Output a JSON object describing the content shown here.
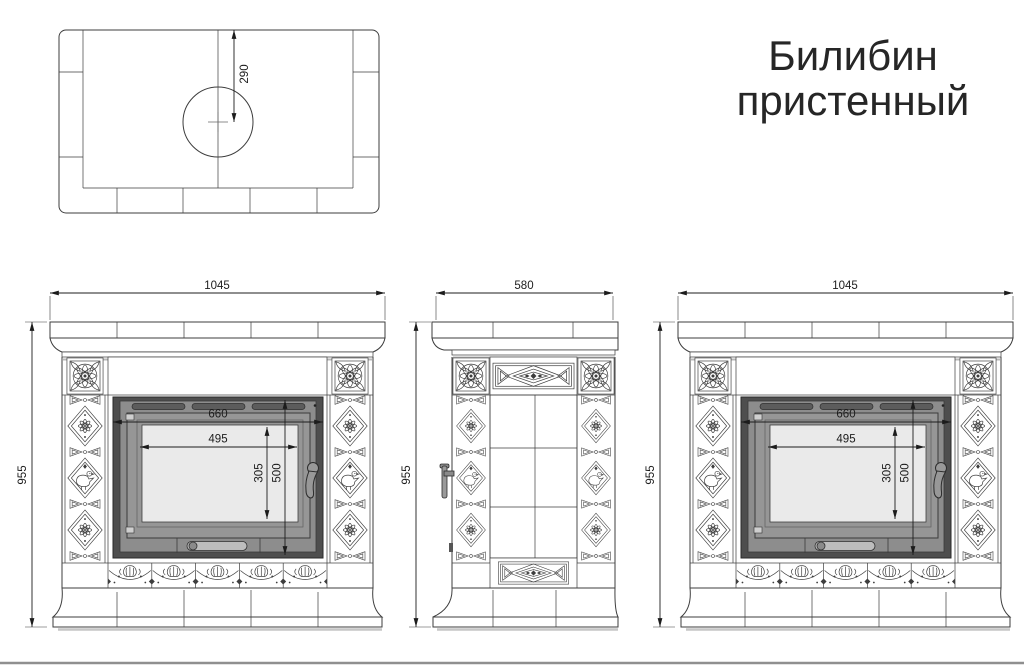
{
  "title": {
    "line1": "Билибин",
    "line2": "пристенный"
  },
  "plan_view": {
    "flue_center_offset": "290"
  },
  "front_view": {
    "width": "1045",
    "height": "955"
  },
  "side_view": {
    "width": "580",
    "height": "955"
  },
  "firebox": {
    "opening_width": "660",
    "glass_width": "495",
    "glass_height": "305",
    "door_height": "500"
  },
  "colors": {
    "line": "#3d3d3d",
    "dimension": "#1c1c1c",
    "firebox_frame": "#4e4e4e",
    "firebox_face": "#8d8d8d",
    "glass": "#eaeaea",
    "background": "#ffffff"
  }
}
